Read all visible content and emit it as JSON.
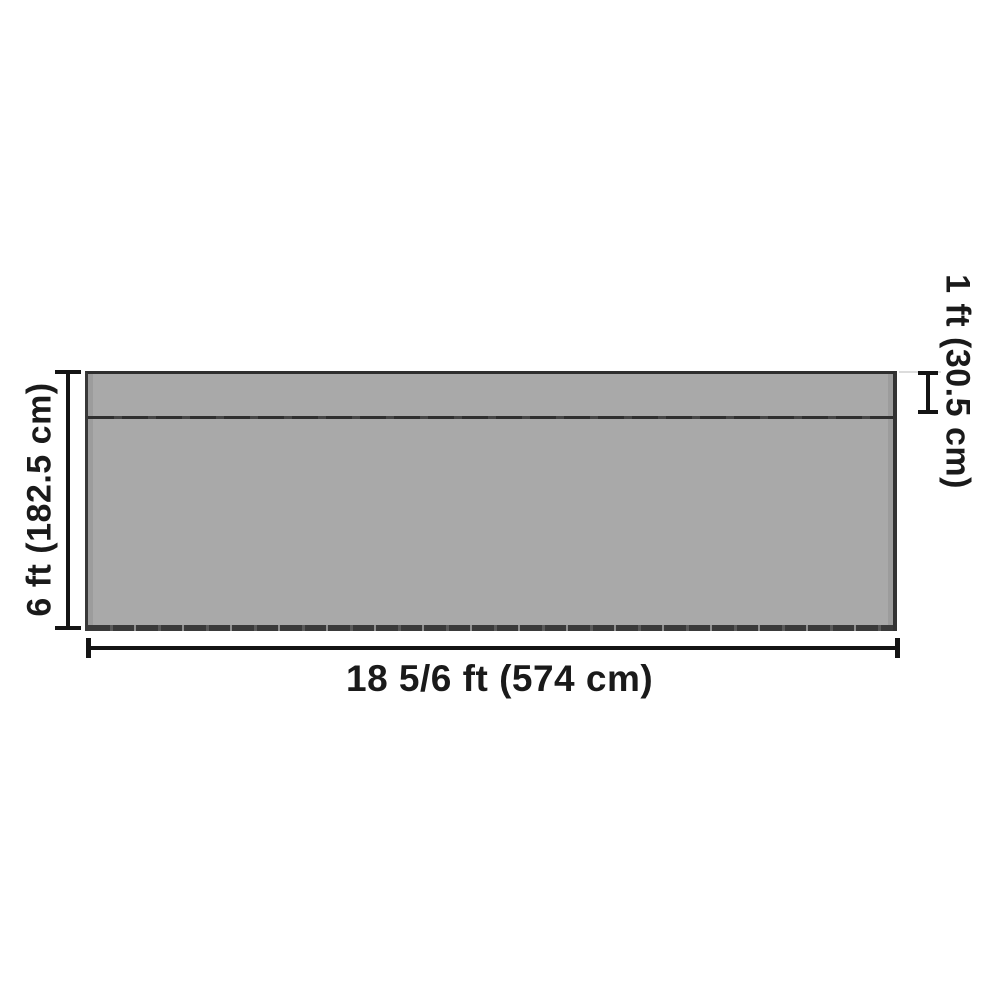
{
  "diagram": {
    "type": "product-dimension-diagram",
    "subject": "rectangular panel with top strip seam",
    "labels": {
      "height": "6 ft (182.5 cm)",
      "width": "18 5/6 ft (574 cm)",
      "top_section": "1 ft (30.5 cm)"
    },
    "colors": {
      "background": "#ffffff",
      "panel_fill": "#a9a9a9",
      "panel_border": "#2e2e2e",
      "seam": "#2f2f2f",
      "hem": "#3a3a3a",
      "dimension_line": "#141414",
      "label_text": "#1a1a1a"
    }
  }
}
